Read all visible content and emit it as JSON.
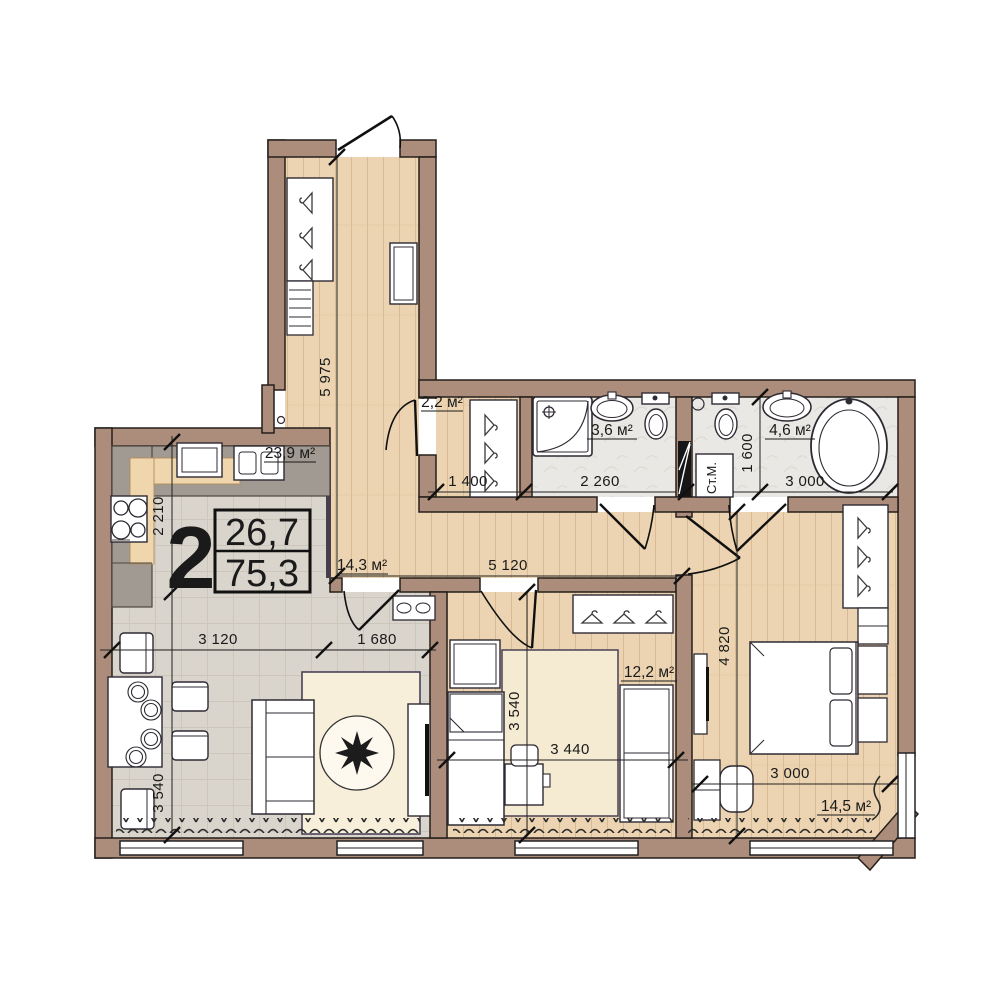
{
  "plan": {
    "info_box": {
      "rooms_count": "2",
      "living_area": "26,7",
      "total_area": "75,3"
    },
    "rooms": {
      "kitchen_living": "23,9 м²",
      "hallway": "14,3 м²",
      "closet": "2,2 м²",
      "bathroom_small": "3,6 м²",
      "bathroom_large": "4,6 м²",
      "bedroom_small": "12,2 м²",
      "bedroom_master": "14,5 м²"
    },
    "appliances": {
      "washing_machine": "Ст.М."
    },
    "dimensions": {
      "hallway_length": "5 975",
      "kitchen_depth": "2 210",
      "living_width_left": "3 120",
      "living_width_right": "1 680",
      "living_depth": "3 540",
      "closet_width": "1 400",
      "bathroom_small_width": "2 260",
      "bathroom_large_width": "3 000",
      "bathroom_large_depth": "1 600",
      "hallway_width": "5 120",
      "bedroom_small_depth": "3 540",
      "bedroom_small_width": "3 440",
      "bedroom_master_depth": "4 820",
      "bedroom_master_width": "3 000"
    },
    "colors": {
      "wall": "#ac8c7a",
      "wood_floor": "#ecd4b2",
      "tile_floor": "#d9d4cc",
      "bath_floor": "#eae8e4",
      "carpet": "#f8efdb",
      "line": "#1a1a1a"
    }
  }
}
